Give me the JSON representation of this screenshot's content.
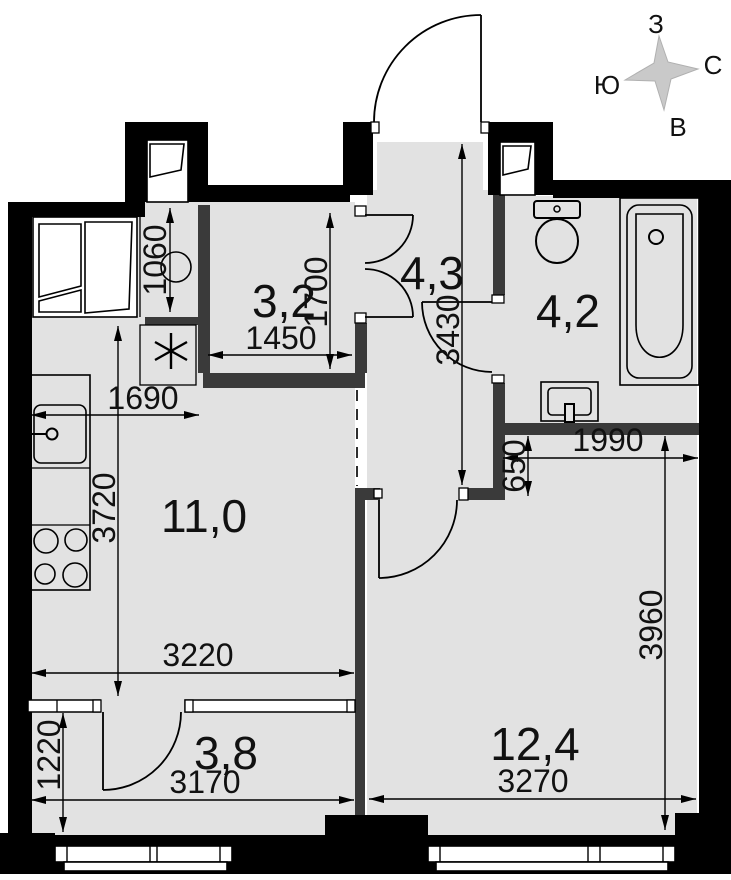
{
  "plan": {
    "compass": {
      "west": "З",
      "north": "С",
      "south": "Ю",
      "east": "В"
    },
    "rooms": {
      "kitchen_living": "11,0",
      "hallway": "4,3",
      "bathroom": "4,2",
      "storage": "3,2",
      "wardrobe": "3,8",
      "living_room": "12,4"
    },
    "dims": {
      "bay_depth": "1060",
      "storage_width": "1450",
      "storage_length": "1700",
      "hallway_length": "3430",
      "kitchen_wall": "1690",
      "kitchen_length": "3720",
      "kitchen_width": "3220",
      "wardrobe_depth": "1220",
      "wardrobe_width": "3170",
      "alcove_depth": "650",
      "alcove_width": "1990",
      "living_length": "3960",
      "living_width": "3270"
    },
    "symbols": {
      "washing_machine": "✳"
    }
  }
}
